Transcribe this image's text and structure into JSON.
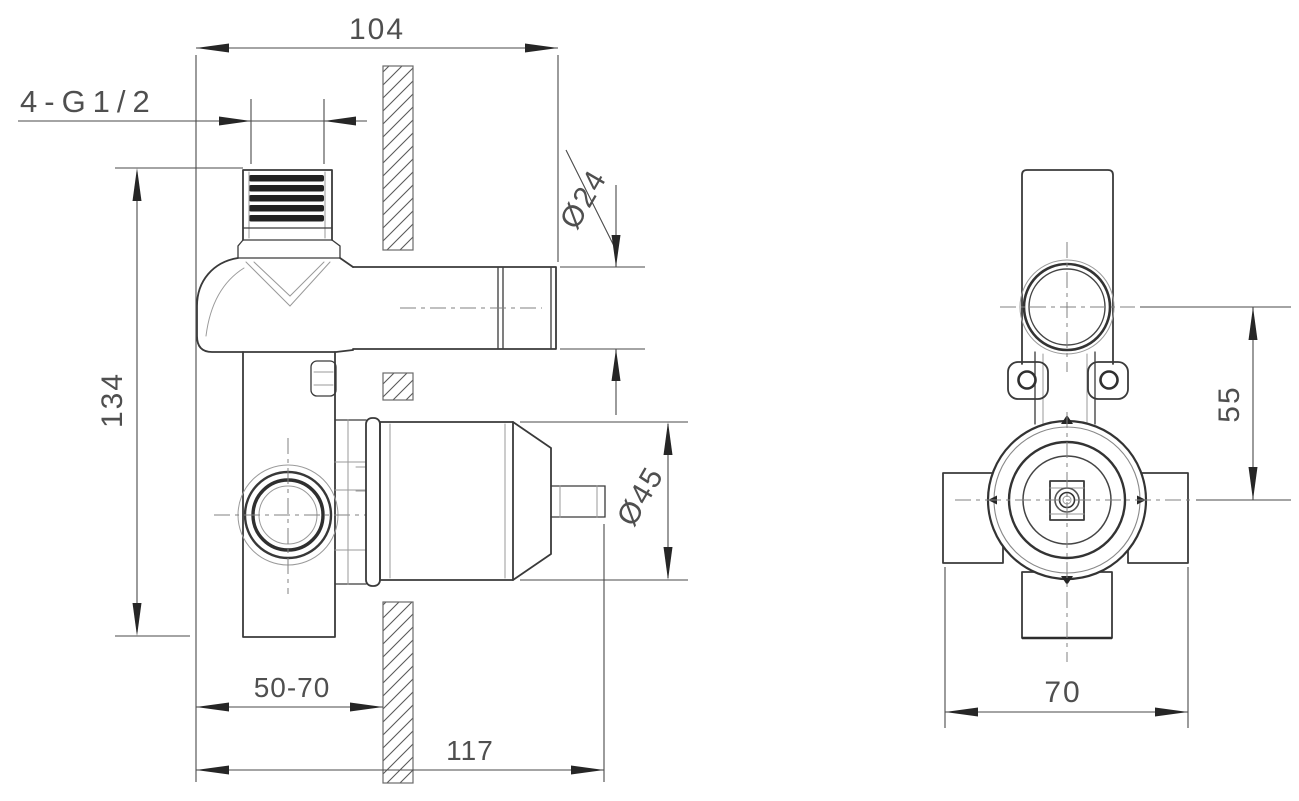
{
  "dimensions": {
    "side_view": {
      "width_104": "104",
      "thread_spec": "4-G1/2",
      "pipe_diameter": "Ø24",
      "overall_height": "134",
      "cartridge_diameter": "Ø45",
      "wall_depth_range": "50-70",
      "overall_depth": "117"
    },
    "front_view": {
      "port_center_offset": "55",
      "body_width": "70"
    }
  },
  "colors": {
    "background": "#ffffff",
    "outline": "#3a3a3a",
    "outline_light": "#9a9a9a",
    "dimension_line": "#4a4a4a",
    "dimension_text": "#4f4f4f",
    "arrow": "#262626",
    "hatch": "#5a5a5a",
    "thread": "#222222"
  }
}
